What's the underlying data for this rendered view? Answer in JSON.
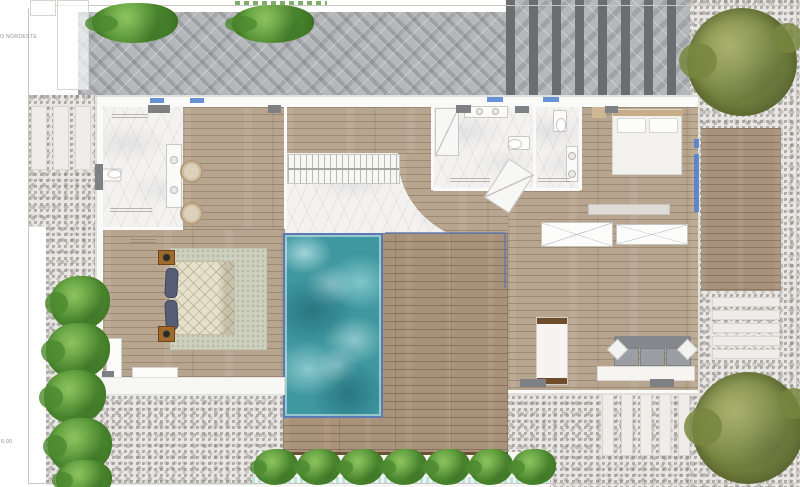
{
  "annotations": {
    "wind_label": "O NORDESTE",
    "time_label": "6:00"
  },
  "palette": {
    "water": "#3f97a0",
    "pool_border": "#5b79b5",
    "wood_interior": "#b7a58f",
    "wood_deck": "#a8927a",
    "wood_patch": "#a7937d",
    "pavers": "#b5b8ba",
    "pavers_stripe": "#6a6e71",
    "gravel": "#e9e7e3",
    "marble": "#f3f2f0",
    "tree_olive": "#87934f",
    "bush_green": "#5f9c3d",
    "window_blue": "#4d7fd0",
    "wall_gray_block": "#7d8184",
    "sofa_gray": "#9b9ea3",
    "pillow_navy": "#565d74",
    "wardrobe_trim": "#6e4c2c"
  },
  "features": [
    "swimming-pool",
    "timber-pool-deck",
    "staircase",
    "marble-foyer",
    "bathroom",
    "suite-deck",
    "bedroom",
    "master-bedroom",
    "living-area",
    "sofa",
    "wardrobe",
    "closets",
    "olive-tree",
    "shrubs",
    "gravel-yard",
    "paver-patio",
    "striped-driveway",
    "stepping-stones",
    "planting-row"
  ]
}
